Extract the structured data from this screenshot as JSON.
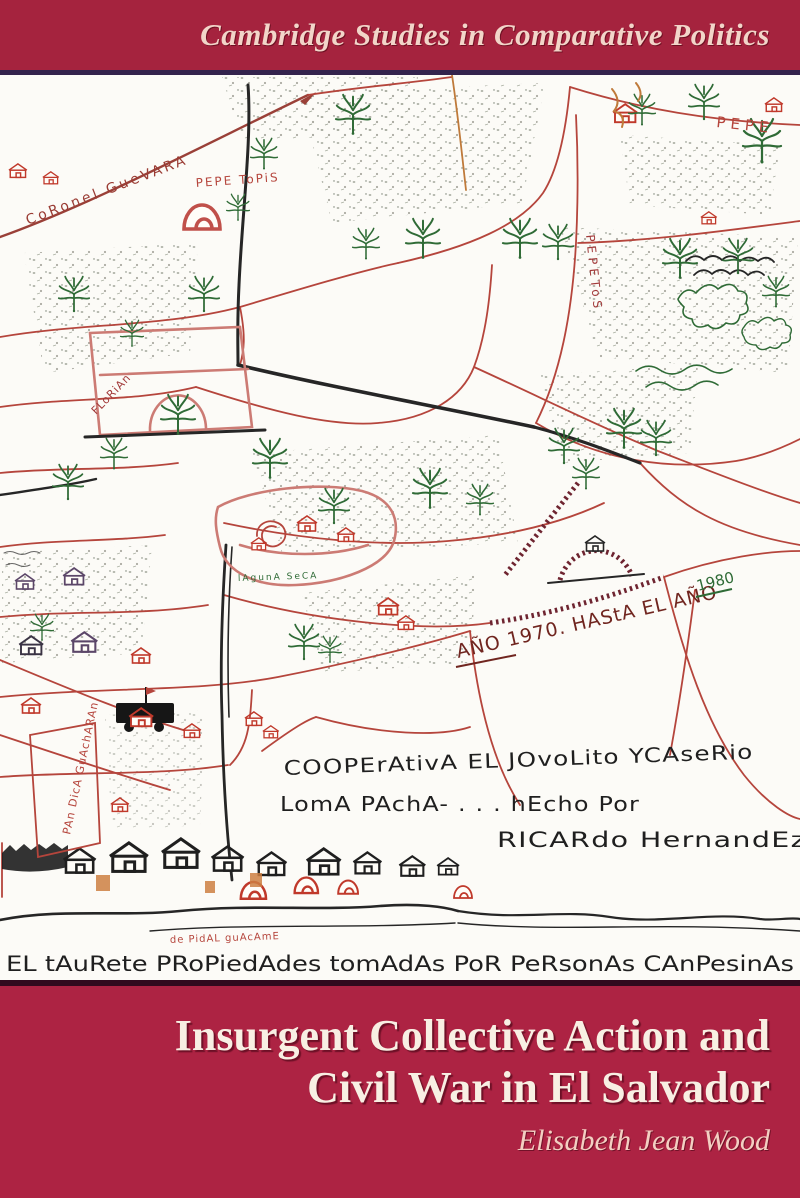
{
  "series_banner": {
    "text": "Cambridge Studies in Comparative Politics"
  },
  "title": {
    "line1": "Insurgent Collective Action and",
    "line2": "Civil War in El Salvador"
  },
  "author": "Elisabeth Jean Wood",
  "colors": {
    "banner_top": "#a5233e",
    "banner_bottom": "#ad2343",
    "rule_top": "#33234d",
    "rule_bottom": "#320a1e",
    "series_text": "#f2d5c9",
    "title_text": "#f8efe3",
    "author_text": "#f3cfc2",
    "map_red_ink": "#b5453c",
    "map_green_ink": "#2f6b36",
    "map_black_ink": "#262626"
  },
  "map": {
    "labels": {
      "coronel": "CoRonel GueVARA",
      "pepe_hill": "PEPE ToPiS",
      "pepe_corner": "PEPE",
      "pepetos_vertical": "PEPEToS",
      "year_range": "AÑO 1970. HAStA EL AÑO",
      "year_1980": "1980",
      "coop_line1": "COOPErAtivA EL JOvoLito YCAseRio",
      "coop_line2": "LomA PAchA- . . . hEcho Por",
      "coop_line3": "RICARdo HernandEz",
      "bottom_caption": "EL tAuRete PRoPiedAdes tomAdAs PoR PeRsonAs CAnPesinAs",
      "small_red": "de PidAL guAcAmE",
      "laguna": "lAgunA SeCA",
      "parcel_box": "PAn DicA GuAchARAn",
      "hillside": "FLoRiAn"
    }
  }
}
